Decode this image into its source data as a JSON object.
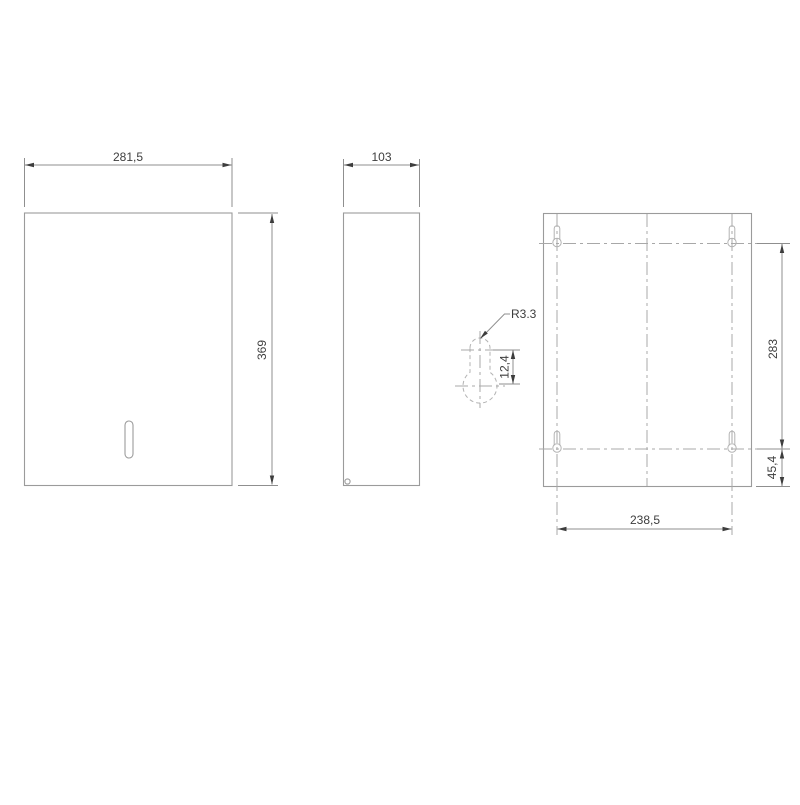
{
  "views": {
    "front": {
      "width_label": "281,5",
      "height_label": "369"
    },
    "side": {
      "depth_label": "103"
    },
    "detail": {
      "radius_label": "R3.3",
      "offset_label": "12,4"
    },
    "back": {
      "holes_height_label": "283",
      "bottom_offset_label": "45,4",
      "holes_spacing_label": "238,5"
    }
  },
  "colors": {
    "background": "#ffffff",
    "object_line": "#9b9b9b",
    "hidden_line": "#b3b3b3",
    "center_line": "#a8a8a8",
    "dimension_line": "#8f8f8f",
    "text": "#3d3d3d"
  }
}
